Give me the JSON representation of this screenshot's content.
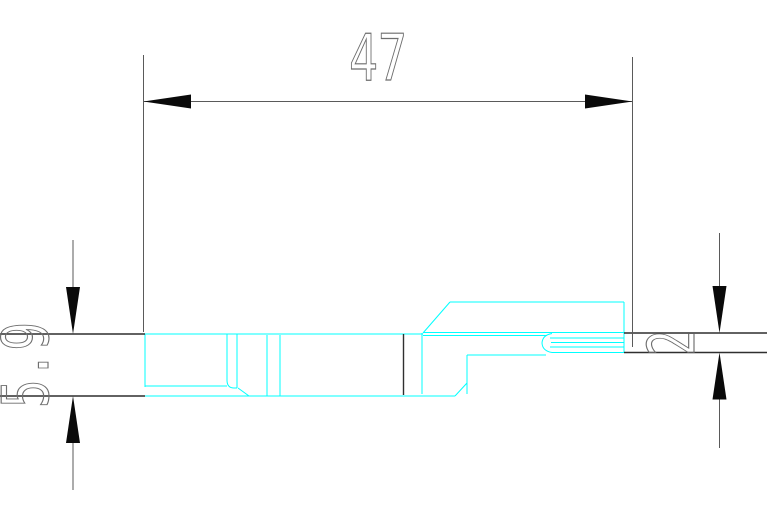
{
  "drawing": {
    "dimensions": {
      "length": {
        "value": "47"
      },
      "height_left": {
        "value": "5.9"
      },
      "height_right": {
        "value": "2"
      }
    },
    "colors": {
      "profile": "#00ffff",
      "blank_outline": "#2f2f2f",
      "dimension_lines": "#5a5a5a",
      "arrows": "#0a0a0a",
      "text": "#6e6e6e",
      "background": "#ffffff"
    }
  }
}
